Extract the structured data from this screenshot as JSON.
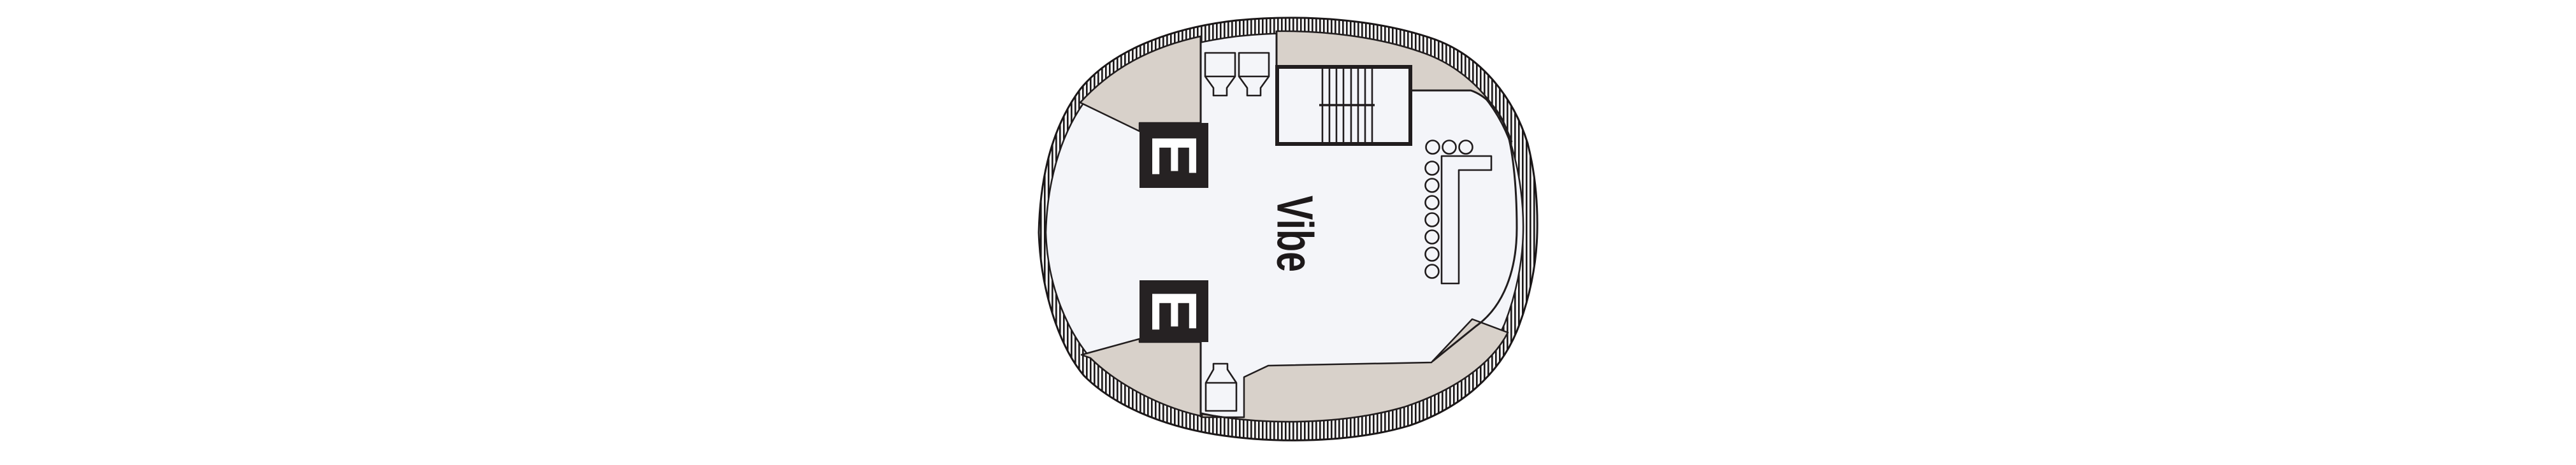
{
  "deck_plan": {
    "venue": {
      "label": "Vibe"
    },
    "elevators": [
      {
        "label": "E"
      },
      {
        "label": "E"
      }
    ],
    "colors": {
      "outline": "#211d1e",
      "hatch": "#1b1718",
      "deck_shade": "#d8d1ca",
      "floor": "#f4f5f9",
      "elevator_fill": "#262223",
      "elevator_text": "#ffffff",
      "label_text": "#1d191a",
      "page_background": "#ffffff"
    },
    "fixtures": {
      "bar_stool_count": 10,
      "staircase_count": 1,
      "deck_fixture_count": 2,
      "bottle_station_count": 1,
      "bar_counter_count": 1
    }
  }
}
